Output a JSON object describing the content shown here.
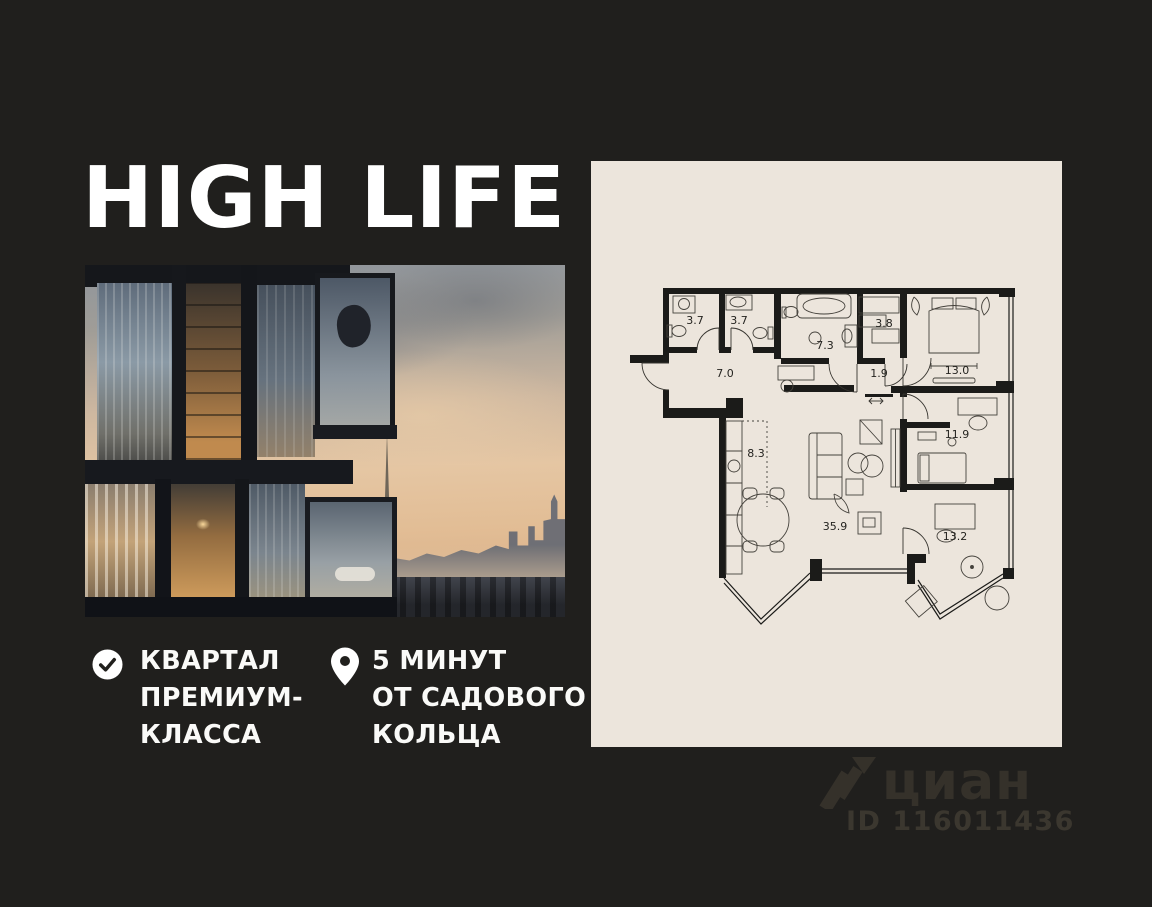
{
  "colors": {
    "background": "#201f1d",
    "panel": "#ece5dc",
    "text": "#ffffff",
    "watermark": "#35312a"
  },
  "logo": {
    "title": "HIGH LIFE"
  },
  "features": [
    {
      "icon": "check-icon",
      "lines": [
        "КВАРТАЛ",
        "ПРЕМИУМ-",
        "КЛАССА"
      ]
    },
    {
      "icon": "pin-icon",
      "lines": [
        "5 МИНУТ",
        "ОТ САДОВОГО",
        "КОЛЬЦА"
      ]
    }
  ],
  "floorplan": {
    "rooms": [
      {
        "name": "bathroom-1",
        "area": "3.7"
      },
      {
        "name": "bathroom-2",
        "area": "3.7"
      },
      {
        "name": "bathroom-3",
        "area": "7.3"
      },
      {
        "name": "wardrobe",
        "area": "3.8"
      },
      {
        "name": "bedroom-1",
        "area": "13.0"
      },
      {
        "name": "hallway",
        "area": "7.0"
      },
      {
        "name": "corridor",
        "area": "1.9"
      },
      {
        "name": "kitchen",
        "area": "8.3"
      },
      {
        "name": "bedroom-2",
        "area": "11.9"
      },
      {
        "name": "living-room",
        "area": "35.9"
      },
      {
        "name": "cabinet",
        "area": "13.2"
      }
    ]
  },
  "watermark": {
    "brand": "циан",
    "listing_id": "ID 116011436"
  }
}
